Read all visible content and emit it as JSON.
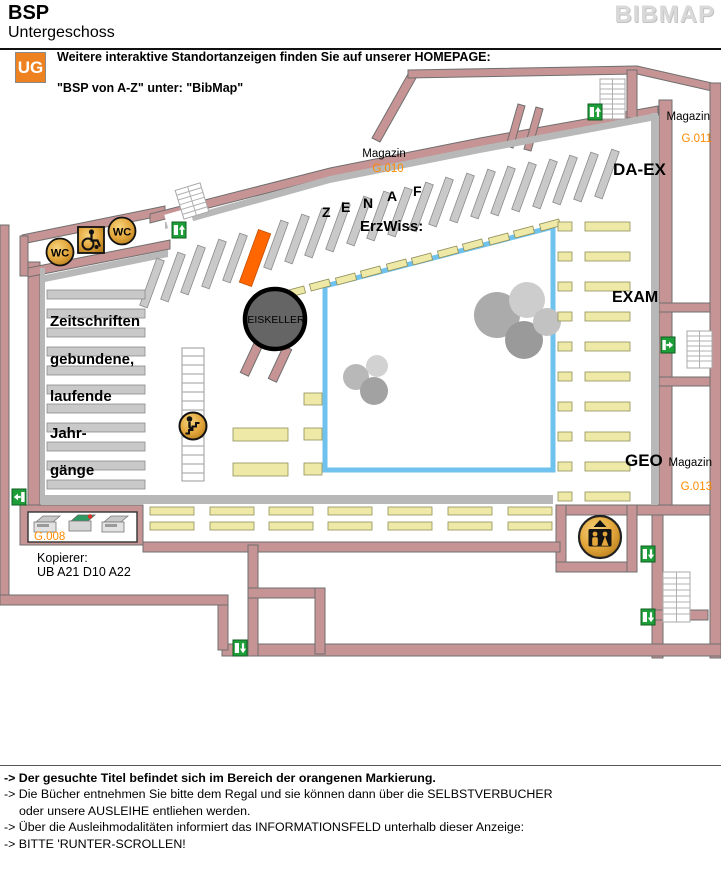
{
  "header": {
    "title": "BSP",
    "subtitle": "Untergeschoss",
    "brand": "BIBMAP"
  },
  "banner": {
    "badge": "UG",
    "line1": "Weitere interaktive Standortanzeigen finden Sie auf unserer HOMEPAGE:",
    "line2": "\"BSP von A-Z\" unter: \"BibMap\""
  },
  "map": {
    "rooms": {
      "magazin_g010": {
        "label": "Magazin",
        "code": "G.010"
      },
      "magazin_g011": {
        "label": "Magazin",
        "code": "G.011"
      },
      "magazin_g013": {
        "label": "Magazin",
        "code": "G.013"
      },
      "kopierer": {
        "code": "G.008",
        "caption1": "Kopierer:",
        "caption2": "UB A21 D10 A22"
      },
      "da_ex": "DA-EX",
      "exam": "EXAM",
      "geo": "GEO",
      "erzwiss": "ErzWiss:",
      "eiskeller": "EISKELLER"
    },
    "zenaf": [
      "Z",
      "E",
      "N",
      "A",
      "F"
    ],
    "wc_label": "WC",
    "icons": {
      "exit": "exit-icon",
      "stairs_person": "stairs-down-icon",
      "elevator": "elevator-icon",
      "wheelchair": "wheelchair-icon",
      "wc": "wc-icon",
      "copier": "copier-icon"
    },
    "colors": {
      "highlight": "#FF6600",
      "wall": "#C69494",
      "shelf_gray": "#CDCDCD",
      "shelf_wood": "#EFE9A8",
      "glass_border": "#6FC2EE",
      "room_code_text": "#FF8A00",
      "exit_green": "#1E9E38",
      "icon_gold": "#E3A73C"
    }
  },
  "footer": {
    "lines": [
      {
        "text": "-> Der gesuchte Titel befindet sich im Bereich der orangenen Markierung."
      },
      {
        "text": "-> Die Bücher entnehmen Sie bitte dem Regal und sie können dann über die SELBSTVERBUCHER"
      },
      {
        "text": "oder unsere AUSLEIHE entliehen werden."
      },
      {
        "text": "-> Über die Ausleihmodalitäten informiert das INFORMATIONSFELD unterhalb dieser Anzeige:"
      },
      {
        "text": "-> BITTE 'RUNTER-SCROLLEN!"
      }
    ]
  }
}
